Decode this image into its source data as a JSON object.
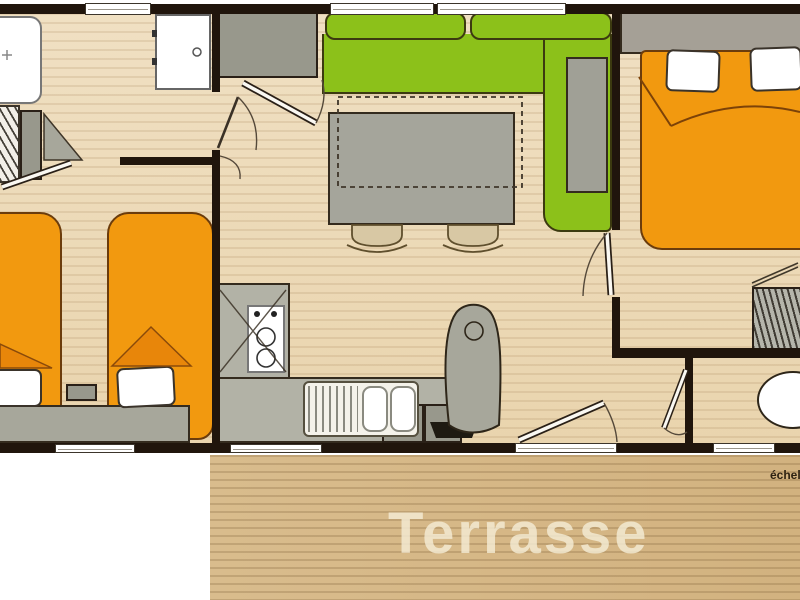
{
  "labels": {
    "terrace": "Terrasse",
    "scale": "échelle"
  },
  "palette": {
    "wall": "#20150C",
    "floor_wood": "#EDDBBA",
    "terrace_wood": "#D6B787",
    "bed_orange": "#F2990F",
    "sofa_green": "#8CC11A",
    "furniture_gray": "#A7A79B",
    "terrace_text": "#F4EBD4"
  },
  "furniture_icons": [
    "bathtub-icon",
    "shelf-unit-icon",
    "corner-shelf-icon",
    "shower-door-icon",
    "storage-cabinet-icon",
    "sofa-icon",
    "dining-table-icon",
    "chair-icon",
    "single-bed-icon",
    "nightstand-icon",
    "headboard-shelf-icon",
    "kitchen-counter-icon",
    "cooktop-icon",
    "sink-icon",
    "armchair-icon",
    "double-bed-icon",
    "wardrobe-icon",
    "toilet-icon",
    "door-icon",
    "window-icon"
  ]
}
